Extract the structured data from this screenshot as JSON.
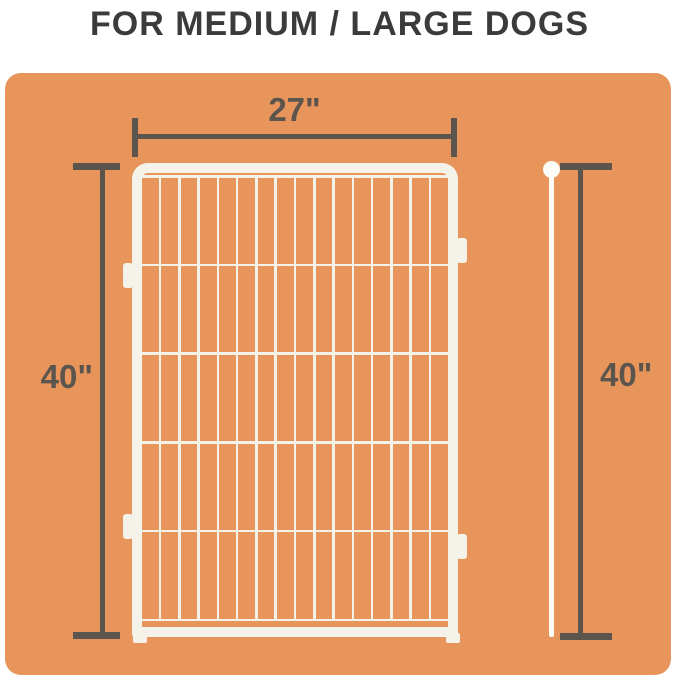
{
  "title": "FOR MEDIUM / LARGE DOGS",
  "dimensions": {
    "width": "27\"",
    "height_left": "40\"",
    "height_right": "40\""
  },
  "fence": {
    "vertical_wires": 15,
    "horizontal_wires": 6,
    "rows": 5
  },
  "colors": {
    "background": "#ffffff",
    "panel_orange": "#e8955c",
    "dimension_dark": "#5c554d",
    "title_text": "#3b3b3b",
    "fence_white": "#f5f2ea",
    "rod_white": "#fdfcf6"
  }
}
